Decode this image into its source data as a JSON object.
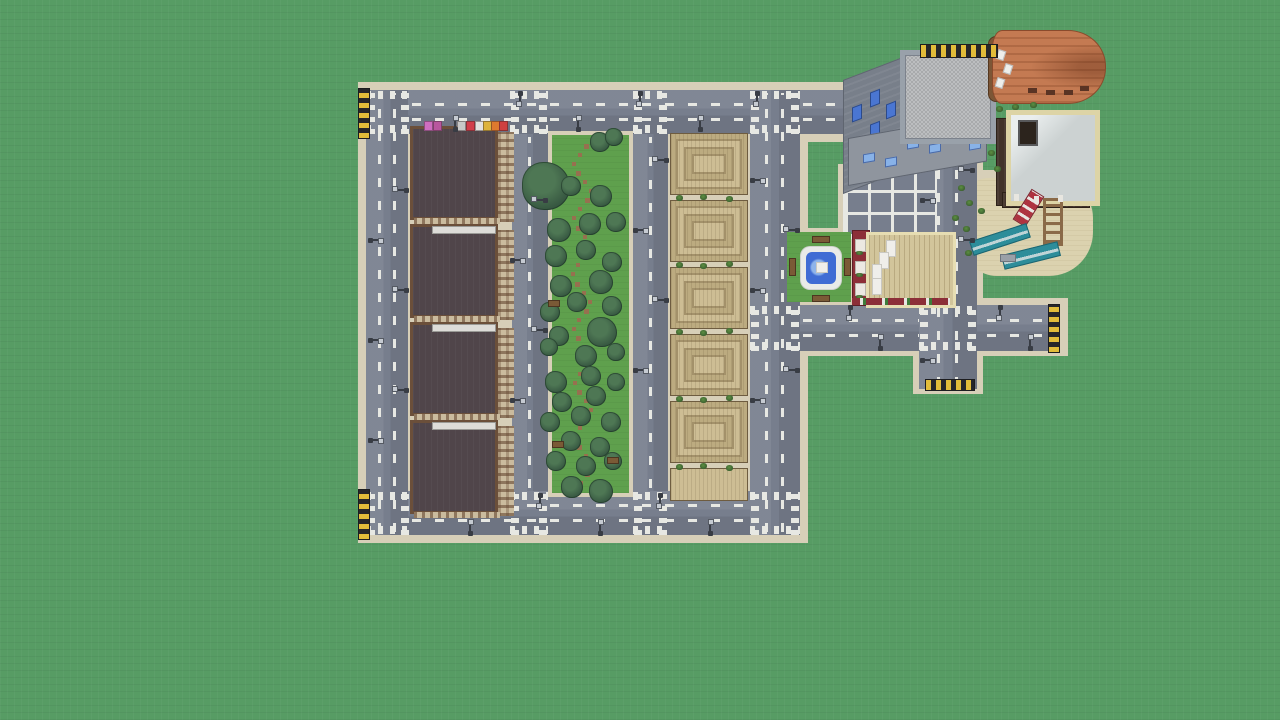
{
  "scene": {
    "name": "voxel-city-aerial-view",
    "description": "Top-down aerial screenshot of a blocky sandbox-game city built on a flat green grass plain: four dark apartment blocks, a tree-filled park strip, six terraced tan buildings, a plaza with fountain, parking lot, playground and several larger buildings, all connected by gray roads with white markings and dead-end hazard barriers",
    "visible_text": "none"
  },
  "counts": {
    "apartment_blocks": 4,
    "terraced_buildings": 6,
    "park_trees": 36,
    "street_lamps": 38,
    "road_dead_ends": 4,
    "crosswalk_intersections": 10
  },
  "palette": {
    "grass": "#579c64",
    "grass_line": "rgba(0,0,0,0.045)",
    "road": "#777e8d",
    "road_light": "rgba(255,255,255,0.07)",
    "road_dark": "rgba(0,0,0,0.08)",
    "sidewalk": "#d7cfb8",
    "marking": "#e7e8e3",
    "hazard_yellow": "#e2bc3a",
    "hazard_black": "#26262a",
    "apt_roof": "#50454a",
    "apt_trim": "#6b4f3a",
    "apt_facade": "#cabb9e",
    "apt_window": "rgba(92,62,40,0.55)",
    "park_green": "#5fa04d",
    "path_brown": "#97704f",
    "tree_dark": "#33523e",
    "tree_mid": "#4e7754",
    "tan_base": "#bcab80",
    "tan_light": "#cdbd94",
    "tan_dark": "#a3916a",
    "tan_edge": "#6e5c40",
    "bush_light": "#5d8f42",
    "bush_dark": "#3c6130",
    "stone_wall": "#8f959e",
    "stone_wall_dark": "#787f8a",
    "stone_roof_a": "#a8aaac",
    "stone_roof_b": "#bcbec0",
    "stone_trim": "#99a1aa",
    "window_blue": "#4a76d2",
    "window_blue_light": "#88b2e8",
    "orange_roof": "#c47a52",
    "orange_ridge": "rgba(122,62,32,0.28)",
    "deck_brown": "#7c5636",
    "white_roof": "#ccd2d2",
    "cream_trim": "#ddd4a6",
    "dark_wall": "#42332a",
    "red_wall": "#8c2f38",
    "birch_roof": "#d2c59b",
    "quartz": "#efeeea",
    "water_blue": "#3f6cd4",
    "water_light": "#8fb4ea",
    "pond_rim": "#e9ebe8",
    "sand": "#dbd2af",
    "teal": "#2d8d9a",
    "slide_red": "#ae3340",
    "bench_brown": "#7a5a36",
    "lamp_dark": "#383c44",
    "lamp_head": "#c6cbd2"
  },
  "world": {
    "apartments": [
      [
        410,
        126
      ],
      [
        410,
        224
      ],
      [
        410,
        322
      ],
      [
        410,
        420
      ]
    ],
    "apartment_size": [
      104,
      96
    ],
    "awnings": [
      [
        424,
        "#cf6ec0"
      ],
      [
        433,
        "#b8579e"
      ],
      [
        457,
        "#c8c8c8"
      ],
      [
        466,
        "#d23d4a"
      ],
      [
        475,
        "#e3e1df"
      ],
      [
        483,
        "#ddb33c"
      ],
      [
        491,
        "#df7a2e"
      ],
      [
        499,
        "#cf4040"
      ]
    ],
    "canopies": [
      [
        432,
        226
      ],
      [
        432,
        324
      ],
      [
        432,
        422
      ]
    ],
    "terraced": [
      [
        133,
        62,
        0
      ],
      [
        200,
        62,
        0
      ],
      [
        267,
        62,
        0
      ],
      [
        334,
        62,
        0
      ],
      [
        401,
        62,
        0
      ],
      [
        468,
        33,
        1
      ]
    ],
    "terraced_x": 670,
    "terraced_w": 78,
    "trees": [
      [
        546,
        186,
        24
      ],
      [
        600,
        142,
        10
      ],
      [
        614,
        137,
        9
      ],
      [
        571,
        186,
        10
      ],
      [
        601,
        196,
        11
      ],
      [
        559,
        230,
        12
      ],
      [
        590,
        224,
        11
      ],
      [
        616,
        222,
        10
      ],
      [
        556,
        256,
        11
      ],
      [
        586,
        250,
        10
      ],
      [
        612,
        262,
        10
      ],
      [
        561,
        286,
        11
      ],
      [
        601,
        282,
        12
      ],
      [
        550,
        312,
        10
      ],
      [
        577,
        302,
        10
      ],
      [
        612,
        306,
        10
      ],
      [
        602,
        332,
        15
      ],
      [
        559,
        336,
        10
      ],
      [
        586,
        356,
        11
      ],
      [
        616,
        352,
        9
      ],
      [
        549,
        347,
        9
      ],
      [
        556,
        382,
        11
      ],
      [
        591,
        376,
        10
      ],
      [
        616,
        382,
        9
      ],
      [
        562,
        402,
        10
      ],
      [
        596,
        396,
        10
      ],
      [
        550,
        422,
        10
      ],
      [
        581,
        416,
        10
      ],
      [
        611,
        422,
        10
      ],
      [
        571,
        441,
        10
      ],
      [
        600,
        447,
        10
      ],
      [
        556,
        461,
        10
      ],
      [
        586,
        466,
        10
      ],
      [
        613,
        461,
        9
      ],
      [
        572,
        487,
        11
      ],
      [
        601,
        491,
        12
      ]
    ],
    "path_dots": [
      [
        584,
        144
      ],
      [
        578,
        153
      ],
      [
        572,
        162
      ],
      [
        576,
        171
      ],
      [
        583,
        180
      ],
      [
        589,
        189
      ],
      [
        585,
        198
      ],
      [
        578,
        207
      ],
      [
        572,
        216
      ],
      [
        576,
        226
      ],
      [
        583,
        235
      ],
      [
        588,
        245
      ],
      [
        583,
        254
      ],
      [
        576,
        263
      ],
      [
        571,
        272
      ],
      [
        575,
        282
      ],
      [
        582,
        291
      ],
      [
        588,
        300
      ],
      [
        584,
        309
      ],
      [
        577,
        318
      ],
      [
        572,
        327
      ],
      [
        576,
        336
      ],
      [
        583,
        345
      ],
      [
        589,
        354
      ],
      [
        585,
        363
      ],
      [
        578,
        372
      ],
      [
        573,
        381
      ],
      [
        577,
        390
      ],
      [
        584,
        399
      ],
      [
        589,
        408
      ],
      [
        585,
        417
      ],
      [
        578,
        426
      ],
      [
        573,
        436
      ],
      [
        577,
        445
      ],
      [
        584,
        454
      ],
      [
        589,
        463
      ],
      [
        585,
        472
      ],
      [
        579,
        481
      ],
      [
        575,
        490
      ]
    ],
    "park_benches": [
      [
        552,
        441
      ],
      [
        607,
        457
      ],
      [
        548,
        300
      ]
    ],
    "bushes": [
      [
        676,
        195
      ],
      [
        700,
        194
      ],
      [
        726,
        196
      ],
      [
        676,
        262
      ],
      [
        700,
        263
      ],
      [
        726,
        261
      ],
      [
        676,
        329
      ],
      [
        700,
        330
      ],
      [
        726,
        328
      ],
      [
        676,
        396
      ],
      [
        700,
        397
      ],
      [
        726,
        395
      ],
      [
        676,
        464
      ],
      [
        700,
        463
      ],
      [
        726,
        465
      ],
      [
        958,
        185
      ],
      [
        966,
        200
      ],
      [
        978,
        208
      ],
      [
        952,
        215
      ],
      [
        988,
        150
      ],
      [
        994,
        166
      ],
      [
        963,
        226
      ],
      [
        965,
        250
      ],
      [
        996,
        106
      ],
      [
        1012,
        104
      ],
      [
        1030,
        102
      ]
    ],
    "lights": [
      [
        455,
        129,
        -90
      ],
      [
        578,
        129,
        -90
      ],
      [
        700,
        129,
        -90
      ],
      [
        520,
        93,
        90
      ],
      [
        640,
        93,
        90
      ],
      [
        757,
        93,
        90
      ],
      [
        370,
        240,
        0
      ],
      [
        370,
        340,
        0
      ],
      [
        370,
        440,
        0
      ],
      [
        406,
        190,
        180
      ],
      [
        406,
        290,
        180
      ],
      [
        406,
        390,
        180
      ],
      [
        512,
        260,
        0
      ],
      [
        512,
        400,
        0
      ],
      [
        545,
        200,
        180
      ],
      [
        545,
        330,
        180
      ],
      [
        635,
        230,
        0
      ],
      [
        635,
        370,
        0
      ],
      [
        666,
        160,
        180
      ],
      [
        666,
        300,
        180
      ],
      [
        752,
        180,
        0
      ],
      [
        752,
        290,
        0
      ],
      [
        752,
        400,
        0
      ],
      [
        797,
        230,
        180
      ],
      [
        797,
        370,
        180
      ],
      [
        470,
        533,
        -90
      ],
      [
        600,
        533,
        -90
      ],
      [
        710,
        533,
        -90
      ],
      [
        540,
        495,
        90
      ],
      [
        660,
        495,
        90
      ],
      [
        850,
        307,
        90
      ],
      [
        1000,
        307,
        90
      ],
      [
        880,
        348,
        -90
      ],
      [
        1030,
        348,
        -90
      ],
      [
        922,
        200,
        0
      ],
      [
        922,
        360,
        0
      ],
      [
        972,
        170,
        180
      ],
      [
        972,
        240,
        180
      ]
    ],
    "hazards": [
      [
        358,
        88,
        10,
        49,
        "v"
      ],
      [
        358,
        489,
        10,
        49,
        "v"
      ],
      [
        1048,
        304,
        10,
        47,
        "v"
      ],
      [
        925,
        379,
        48,
        10,
        "h"
      ],
      [
        920,
        44,
        76,
        12,
        "h"
      ]
    ],
    "crosswalks": [
      [
        366,
        90,
        44,
        44
      ],
      [
        510,
        90,
        38,
        44
      ],
      [
        633,
        90,
        35,
        44
      ],
      [
        750,
        90,
        50,
        44
      ],
      [
        366,
        491,
        44,
        44
      ],
      [
        510,
        491,
        38,
        44
      ],
      [
        633,
        491,
        35,
        44
      ],
      [
        750,
        491,
        50,
        44
      ],
      [
        750,
        305,
        50,
        46
      ],
      [
        919,
        305,
        58,
        46
      ]
    ],
    "stone_windows_left": [
      [
        8,
        30
      ],
      [
        8,
        62
      ],
      [
        8,
        92
      ],
      [
        26,
        22
      ],
      [
        26,
        54
      ],
      [
        42,
        40
      ],
      [
        42,
        72
      ]
    ],
    "stone_windows_bottom": [
      [
        14,
        18
      ],
      [
        36,
        26
      ],
      [
        58,
        12
      ],
      [
        80,
        20
      ],
      [
        104,
        14
      ],
      [
        120,
        24
      ]
    ],
    "white_doors": [
      [
        1014,
        194
      ],
      [
        1034,
        196
      ],
      [
        1058,
        195
      ]
    ],
    "red_windows": [
      [
        2,
        8
      ],
      [
        2,
        30
      ],
      [
        2,
        52
      ]
    ],
    "quartz_stairs": [
      [
        886,
        240
      ],
      [
        879,
        252
      ],
      [
        872,
        264
      ],
      [
        872,
        278
      ]
    ],
    "deck_items_white": [
      [
        997,
        50
      ],
      [
        1004,
        64
      ],
      [
        996,
        78
      ]
    ],
    "orange_windows": [
      [
        1028,
        88
      ],
      [
        1046,
        90
      ],
      [
        1064,
        90
      ],
      [
        1080,
        86
      ]
    ]
  }
}
